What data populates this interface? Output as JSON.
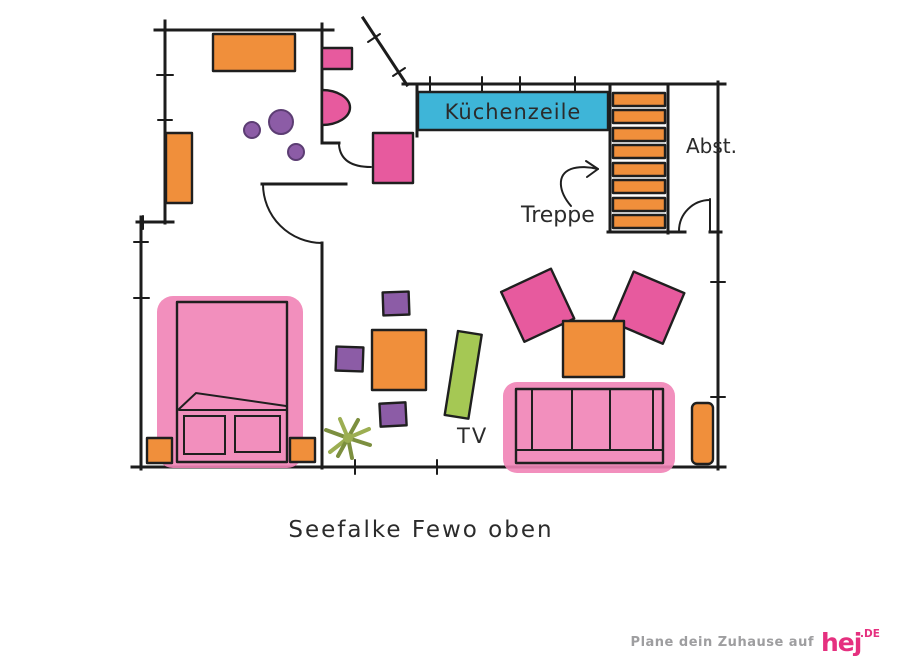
{
  "title": "Seefalke Fewo oben",
  "plan": {
    "labels": {
      "kitchen_unit": "Küchenzeile",
      "stairs": "Treppe",
      "storage": "Abst.",
      "tv": "TV"
    },
    "stairs_step_count": 8
  },
  "footer": {
    "tagline": "Plane dein Zuhause auf",
    "brand": "hej",
    "brand_suffix": ".DE"
  },
  "colors": {
    "orange": "#F08F3B",
    "pink": "#E75A9E",
    "pink_wash": "#F183B6",
    "purple": "#8C5CA6",
    "blue": "#3EB5D8",
    "green": "#A5C854",
    "plant_green": "#7C8F3F",
    "plant_green_light": "#9CAE52",
    "wall_ink": "#1C1C1C",
    "text_ink": "#2B2B2B",
    "brand_pink": "#E5307F",
    "tagline_gray": "#9E9EA0"
  }
}
